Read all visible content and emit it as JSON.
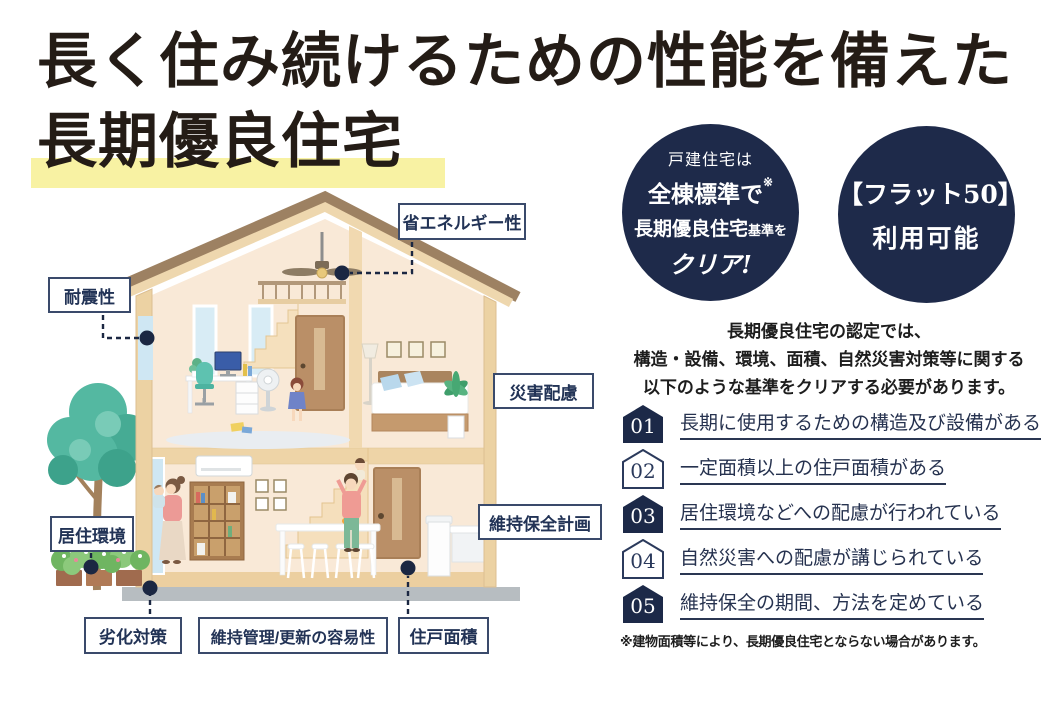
{
  "title": {
    "line1": "長く住み続けるための性能を備えた",
    "line2": "長期優良住宅"
  },
  "circles": {
    "standard": {
      "line1": "戸建住宅は",
      "line2": "全棟標準で",
      "line2_note": "※",
      "line3_large": "長期優良住宅",
      "line3_small": "基準を",
      "line4": "クリア!"
    },
    "flat50": {
      "line1": "【フラット50】",
      "line2": "利用可能"
    }
  },
  "intro": {
    "line1": "長期優良住宅の認定では、",
    "line2": "構造・設備、環境、面積、自然災害対策等に関する",
    "line3": "以下のような基準をクリアする必要があります。"
  },
  "criteria": [
    {
      "num": "01",
      "text": "長期に使用するための構造及び設備がある"
    },
    {
      "num": "02",
      "text": "一定面積以上の住戸面積がある"
    },
    {
      "num": "03",
      "text": "居住環境などへの配慮が行われている"
    },
    {
      "num": "04",
      "text": "自然災害への配慮が講じられている"
    },
    {
      "num": "05",
      "text": "維持保全の期間、方法を定めている"
    }
  ],
  "footnote": "※建物面積等により、長期優良住宅とならない場合があります。",
  "house_labels": {
    "earthquake": "耐震性",
    "energy": "省エネルギー性",
    "disaster": "災害配慮",
    "maintenance_plan": "維持保全計画",
    "living_env": "居住環境",
    "deterioration": "劣化対策",
    "maintainability": "維持管理/更新の容易性",
    "floor_area": "住戸面積"
  },
  "colors": {
    "navy": "#1e2a4a",
    "highlight_yellow": "#f8f2a3",
    "title_ink": "#241c16"
  }
}
